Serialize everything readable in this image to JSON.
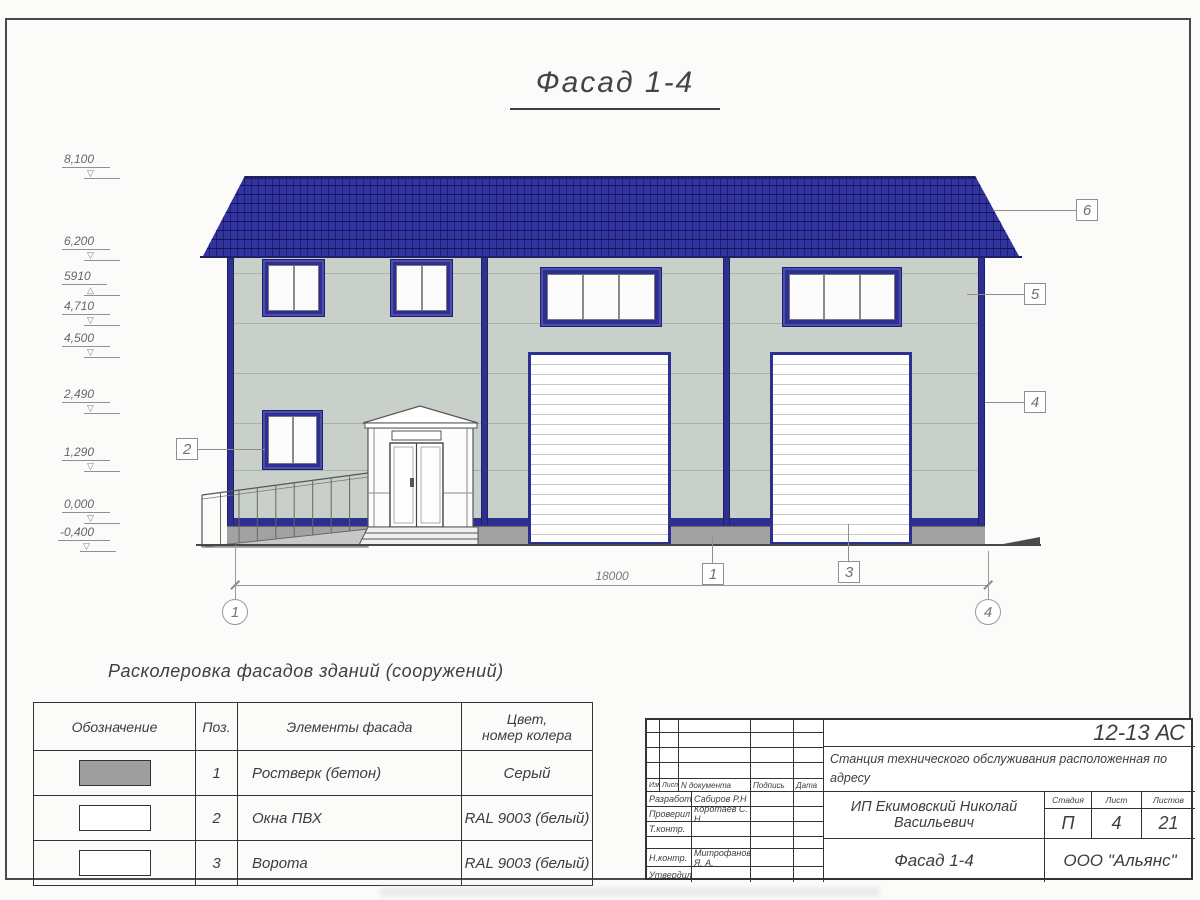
{
  "sheet": {
    "title": "Фасад 1-4",
    "dimension_total": "18000",
    "axis_left": "1",
    "axis_right": "4"
  },
  "levels": [
    {
      "value": "8,100"
    },
    {
      "value": "6,200"
    },
    {
      "value": "5910"
    },
    {
      "value": "4,710"
    },
    {
      "value": "4,500"
    },
    {
      "value": "2,490"
    },
    {
      "value": "1,290"
    },
    {
      "value": "0,000"
    },
    {
      "value": "-0,400"
    }
  ],
  "callouts": [
    {
      "label": "1"
    },
    {
      "label": "2"
    },
    {
      "label": "3"
    },
    {
      "label": "4"
    },
    {
      "label": "5"
    },
    {
      "label": "6"
    }
  ],
  "legend": {
    "heading": "Расколеровка фасадов зданий (сооружений)",
    "col_designation": "Обозначение",
    "col_pos": "Поз.",
    "col_element": "Элементы фасада",
    "col_color": "Цвет,\nномер колера",
    "rows": [
      {
        "pos": "1",
        "element": "Ростверк (бетон)",
        "color": "Серый",
        "swatch_hex": "#9e9e9e"
      },
      {
        "pos": "2",
        "element": "Окна ПВХ",
        "color": "RAL 9003 (белый)",
        "swatch_hex": "#ffffff"
      },
      {
        "pos": "3",
        "element": "Ворота",
        "color": "RAL 9003 (белый)",
        "swatch_hex": "#ffffff"
      }
    ]
  },
  "titleblock": {
    "code": "12-13 АС",
    "project_line1": "Станция технического обслуживания расположенная по адресу",
    "project_line2": "Кировская обл, Слободской р-н, д. Трушковы.",
    "head_izm": "Изм.",
    "head_list": "Лист",
    "head_ndoc": "N документа",
    "head_sign": "Подпись",
    "head_date": "Дата",
    "roles": [
      {
        "role": "Разработал",
        "name": "Сабиров Р.Н"
      },
      {
        "role": "Проверил",
        "name": "Коротаев С. Н."
      },
      {
        "role": "Т.контр.",
        "name": ""
      },
      {
        "role": "",
        "name": ""
      },
      {
        "role": "Н.контр.",
        "name": "Митрофанов Я. А."
      },
      {
        "role": "Утвердил",
        "name": ""
      }
    ],
    "client": "ИП Екимовский Николай Васильевич",
    "stage_label": "Стадия",
    "list_label": "Лист",
    "listov_label": "Листов",
    "stage": "П",
    "list_no": "4",
    "listov": "21",
    "drawing_title": "Фасад 1-4",
    "org": "ООО \"Альянс\""
  },
  "palette": {
    "roof_navy": "#3033a0",
    "trim_navy": "#2d3090",
    "wall_gray_green": "#c9cfc9",
    "plinth_gray": "#a2a2a2",
    "door_white": "#ffffff"
  }
}
